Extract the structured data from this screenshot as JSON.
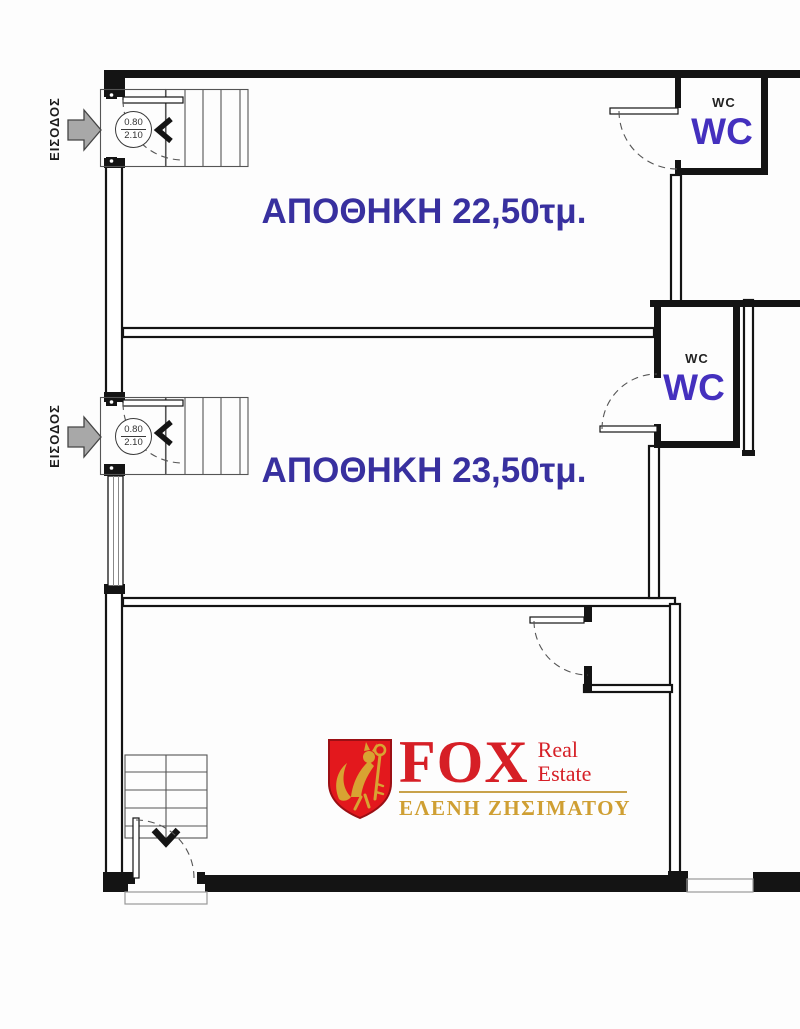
{
  "colors": {
    "wall": "#141414",
    "label_blue": "#38309F",
    "wc_purple": "#4430BE",
    "logo_red": "#D61F26",
    "shield_red": "#E3181D",
    "logo_gold": "#C8A24A",
    "agent_gold": "#CF9F33",
    "arrow_gray": "#A8A8A8"
  },
  "entrances": [
    {
      "label": "ΕΙΣΟΔΟΣ",
      "door_width": "0.80",
      "door_height": "2.10"
    },
    {
      "label": "ΕΙΣΟΔΟΣ",
      "door_width": "0.80",
      "door_height": "2.10"
    }
  ],
  "rooms": [
    {
      "label": "ΑΠΟΘΗΚΗ 22,50τμ."
    },
    {
      "label": "ΑΠΟΘΗΚΗ 23,50τμ."
    }
  ],
  "wcs": [
    {
      "small_label": "WC",
      "big_label": "WC"
    },
    {
      "small_label": "WC",
      "big_label": "WC"
    }
  ],
  "logo": {
    "brand": "FOX",
    "subtitle_line1": "Real",
    "subtitle_line2": "Estate",
    "agent": "ΕΛΕΝΗ ΖΗΣΙΜΑΤΟΥ",
    "emblem": "fox-holding-key-shield-icon"
  }
}
